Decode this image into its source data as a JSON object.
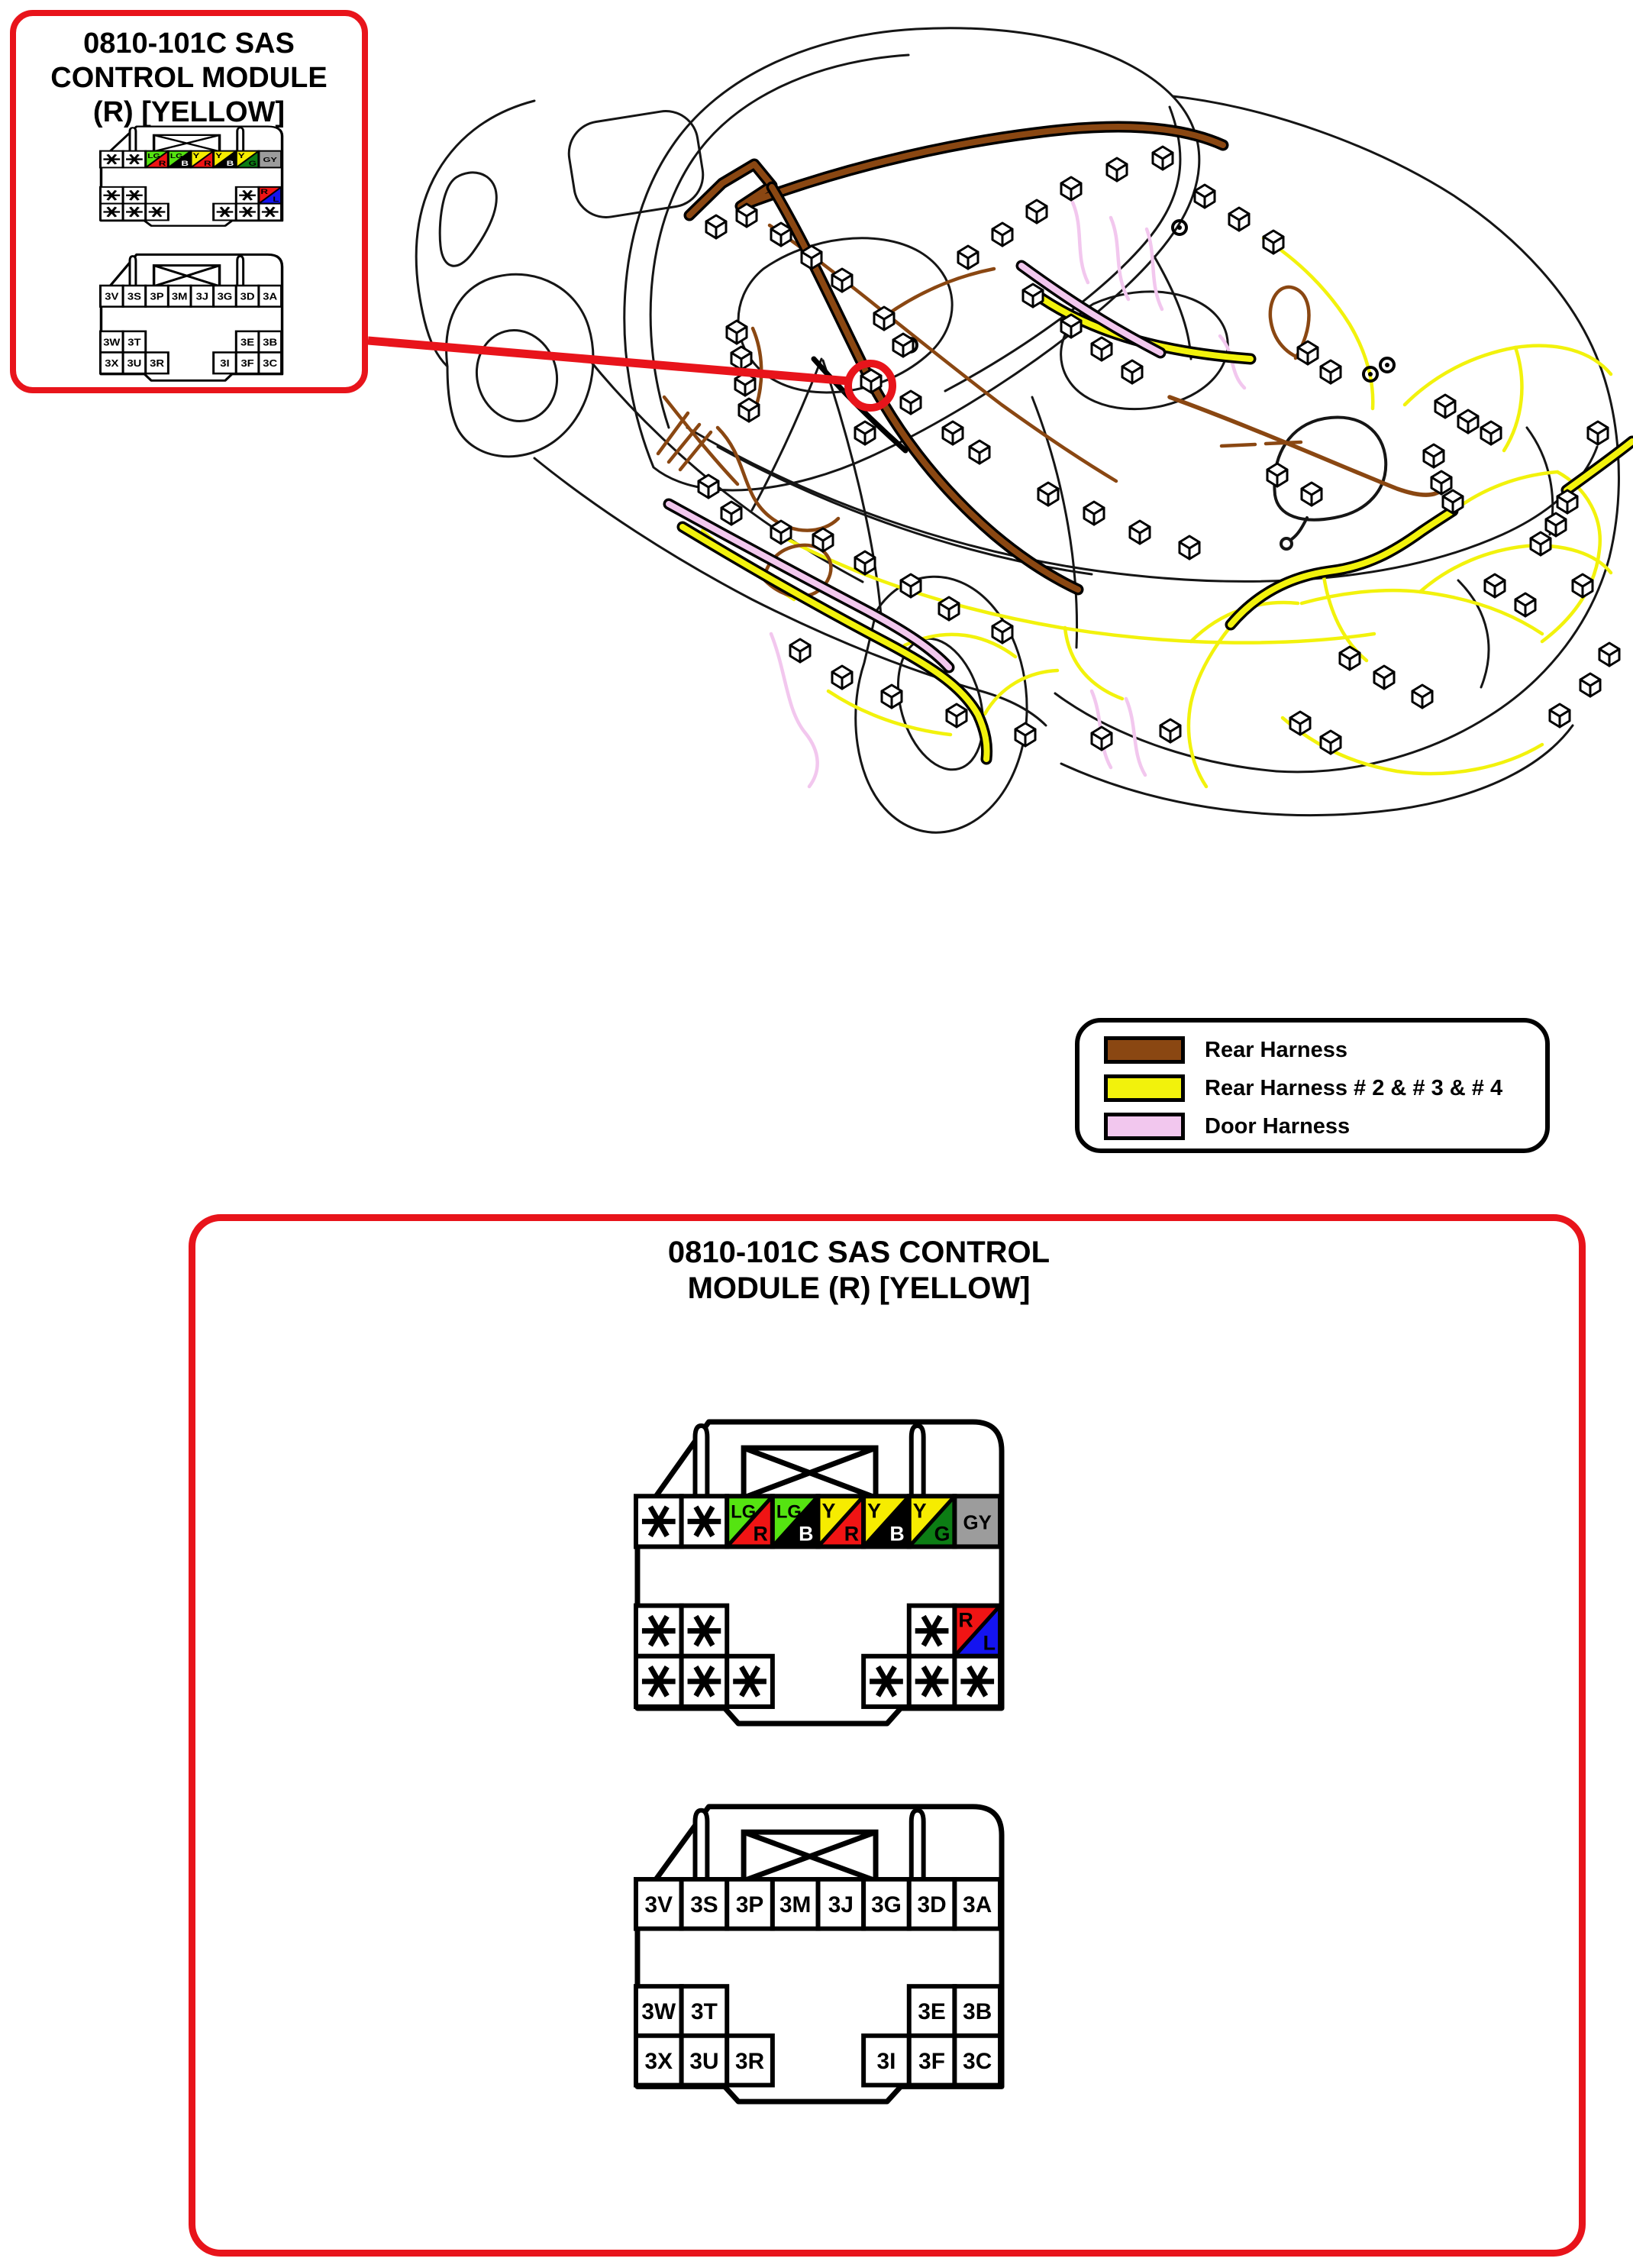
{
  "top_box": {
    "title_lines": [
      "0810-101C SAS",
      "CONTROL MODULE",
      "(R) [YELLOW]"
    ]
  },
  "bottom_box": {
    "title_lines": [
      "0810-101C SAS CONTROL",
      "MODULE (R) [YELLOW]"
    ]
  },
  "legend": {
    "items": [
      {
        "id": "rear-harness",
        "label": "Rear Harness",
        "color": "#8A4712"
      },
      {
        "id": "rear-harness-2-3-4",
        "label": "Rear Harness # 2 & # 3 & # 4",
        "color": "#F2F20C"
      },
      {
        "id": "door-harness",
        "label": "Door Harness",
        "color": "#F2C7EE"
      }
    ]
  },
  "wire_colors": {
    "LG": "#55E411",
    "R": "#F01414",
    "B": "#000000",
    "Y": "#F6EC00",
    "G": "#0C7D14",
    "GY": "#9C9C9C",
    "L": "#1414F0"
  },
  "wire_letter_colors": {
    "B": "#FFFFFF"
  },
  "connectors": {
    "upper": {
      "name": "upper-connector",
      "rows": [
        {
          "cells": [
            {
              "col": 0,
              "kind": "star"
            },
            {
              "col": 1,
              "kind": "star"
            },
            {
              "col": 2,
              "kind": "split",
              "tl": "LG",
              "br": "R"
            },
            {
              "col": 3,
              "kind": "split",
              "tl": "LG",
              "br": "B"
            },
            {
              "col": 4,
              "kind": "split",
              "tl": "Y",
              "br": "R"
            },
            {
              "col": 5,
              "kind": "split",
              "tl": "Y",
              "br": "B"
            },
            {
              "col": 6,
              "kind": "split",
              "tl": "Y",
              "br": "G"
            },
            {
              "col": 7,
              "kind": "solid",
              "code": "GY"
            }
          ]
        },
        {
          "cells": [
            {
              "col": 0,
              "kind": "star"
            },
            {
              "col": 1,
              "kind": "star"
            },
            {
              "col": 6,
              "kind": "star"
            },
            {
              "col": 7,
              "kind": "split",
              "tl": "R",
              "br": "L"
            }
          ]
        },
        {
          "cells": [
            {
              "col": 0,
              "kind": "star"
            },
            {
              "col": 1,
              "kind": "star"
            },
            {
              "col": 2,
              "kind": "star"
            },
            {
              "col": 5,
              "kind": "star"
            },
            {
              "col": 6,
              "kind": "star"
            },
            {
              "col": 7,
              "kind": "star"
            }
          ]
        }
      ]
    },
    "lower": {
      "name": "lower-connector",
      "rows": [
        {
          "cells": [
            {
              "col": 0,
              "kind": "label",
              "text": "3V"
            },
            {
              "col": 1,
              "kind": "label",
              "text": "3S"
            },
            {
              "col": 2,
              "kind": "label",
              "text": "3P"
            },
            {
              "col": 3,
              "kind": "label",
              "text": "3M"
            },
            {
              "col": 4,
              "kind": "label",
              "text": "3J"
            },
            {
              "col": 5,
              "kind": "label",
              "text": "3G"
            },
            {
              "col": 6,
              "kind": "label",
              "text": "3D"
            },
            {
              "col": 7,
              "kind": "label",
              "text": "3A"
            }
          ]
        },
        {
          "cells": [
            {
              "col": 0,
              "kind": "label",
              "text": "3W"
            },
            {
              "col": 1,
              "kind": "label",
              "text": "3T"
            },
            {
              "col": 6,
              "kind": "label",
              "text": "3E"
            },
            {
              "col": 7,
              "kind": "label",
              "text": "3B"
            }
          ]
        },
        {
          "cells": [
            {
              "col": 0,
              "kind": "label",
              "text": "3X"
            },
            {
              "col": 1,
              "kind": "label",
              "text": "3U"
            },
            {
              "col": 2,
              "kind": "label",
              "text": "3R"
            },
            {
              "col": 5,
              "kind": "label",
              "text": "3I"
            },
            {
              "col": 6,
              "kind": "label",
              "text": "3F"
            },
            {
              "col": 7,
              "kind": "label",
              "text": "3C"
            }
          ]
        }
      ]
    }
  }
}
